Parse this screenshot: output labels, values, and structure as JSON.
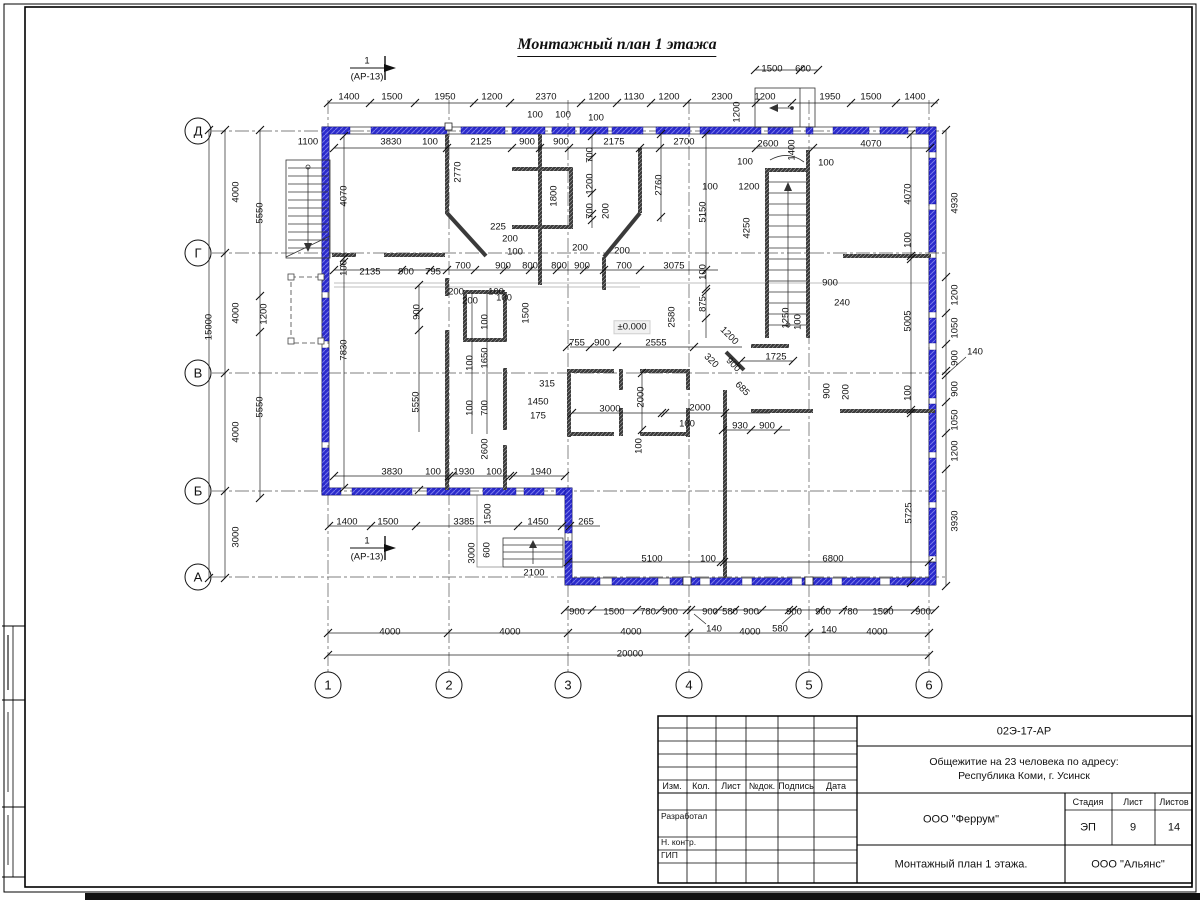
{
  "drawing_title": "Монтажный план 1 этажа",
  "level_mark": "±0.000",
  "axes": {
    "rows": [
      {
        "label": "Д",
        "x": 198,
        "y": 131
      },
      {
        "label": "Г",
        "x": 198,
        "y": 253
      },
      {
        "label": "В",
        "x": 198,
        "y": 373
      },
      {
        "label": "Б",
        "x": 198,
        "y": 491
      },
      {
        "label": "А",
        "x": 198,
        "y": 577
      }
    ],
    "cols": [
      {
        "label": "1",
        "x": 328,
        "y": 685
      },
      {
        "label": "2",
        "x": 449,
        "y": 685
      },
      {
        "label": "3",
        "x": 568,
        "y": 685
      },
      {
        "label": "4",
        "x": 689,
        "y": 685
      },
      {
        "label": "5",
        "x": 809,
        "y": 685
      },
      {
        "label": "6",
        "x": 929,
        "y": 685
      }
    ]
  },
  "section_marks": [
    {
      "num": "1",
      "ref": "(АР-13)",
      "x": 367,
      "y_num": 61,
      "y_ref": 77
    },
    {
      "num": "1",
      "ref": "(АР-13)",
      "x": 367,
      "y_num": 541,
      "y_ref": 557
    }
  ],
  "labels": [
    {
      "t": "1400",
      "x": 349,
      "y": 97
    },
    {
      "t": "1500",
      "x": 392,
      "y": 97
    },
    {
      "t": "1950",
      "x": 445,
      "y": 97
    },
    {
      "t": "1200",
      "x": 492,
      "y": 97
    },
    {
      "t": "2370",
      "x": 546,
      "y": 97
    },
    {
      "t": "1200",
      "x": 599,
      "y": 97
    },
    {
      "t": "1130",
      "x": 634,
      "y": 97
    },
    {
      "t": "1200",
      "x": 669,
      "y": 97
    },
    {
      "t": "2300",
      "x": 722,
      "y": 97
    },
    {
      "t": "1200",
      "x": 765,
      "y": 97
    },
    {
      "t": "1950",
      "x": 830,
      "y": 97
    },
    {
      "t": "1500",
      "x": 871,
      "y": 97
    },
    {
      "t": "1400",
      "x": 915,
      "y": 97
    },
    {
      "t": "1500",
      "x": 772,
      "y": 69
    },
    {
      "t": "600",
      "x": 803,
      "y": 69
    },
    {
      "t": "1200",
      "x": 737,
      "y": 112,
      "r": -90
    },
    {
      "t": "1100",
      "x": 308,
      "y": 142
    },
    {
      "t": "3830",
      "x": 391,
      "y": 142
    },
    {
      "t": "100",
      "x": 430,
      "y": 142
    },
    {
      "t": "2125",
      "x": 481,
      "y": 142
    },
    {
      "t": "900",
      "x": 527,
      "y": 142
    },
    {
      "t": "900",
      "x": 561,
      "y": 142
    },
    {
      "t": "2175",
      "x": 614,
      "y": 142
    },
    {
      "t": "2700",
      "x": 684,
      "y": 142
    },
    {
      "t": "2600",
      "x": 768,
      "y": 144
    },
    {
      "t": "1400",
      "x": 792,
      "y": 150,
      "r": -90
    },
    {
      "t": "4070",
      "x": 871,
      "y": 144
    },
    {
      "t": "100",
      "x": 535,
      "y": 115
    },
    {
      "t": "100",
      "x": 563,
      "y": 115
    },
    {
      "t": "100",
      "x": 596,
      "y": 118
    },
    {
      "t": "100",
      "x": 745,
      "y": 162
    },
    {
      "t": "100",
      "x": 826,
      "y": 163
    },
    {
      "t": "100",
      "x": 710,
      "y": 187
    },
    {
      "t": "1200",
      "x": 749,
      "y": 187
    },
    {
      "t": "15000",
      "x": 209,
      "y": 327,
      "r": -90
    },
    {
      "t": "4000",
      "x": 236,
      "y": 192,
      "r": -90
    },
    {
      "t": "5550",
      "x": 260,
      "y": 213,
      "r": -90
    },
    {
      "t": "4000",
      "x": 236,
      "y": 313,
      "r": -90
    },
    {
      "t": "1200",
      "x": 264,
      "y": 314,
      "r": -90
    },
    {
      "t": "4000",
      "x": 236,
      "y": 432,
      "r": -90
    },
    {
      "t": "5550",
      "x": 260,
      "y": 407,
      "r": -90
    },
    {
      "t": "3000",
      "x": 236,
      "y": 537,
      "r": -90
    },
    {
      "t": "4070",
      "x": 344,
      "y": 196,
      "r": -90
    },
    {
      "t": "100",
      "x": 344,
      "y": 268,
      "r": -90
    },
    {
      "t": "7830",
      "x": 344,
      "y": 350,
      "r": -90
    },
    {
      "t": "2770",
      "x": 458,
      "y": 172,
      "r": -90
    },
    {
      "t": "1800",
      "x": 554,
      "y": 196,
      "r": -90
    },
    {
      "t": "700",
      "x": 590,
      "y": 155,
      "r": -90
    },
    {
      "t": "1200",
      "x": 590,
      "y": 184,
      "r": -90
    },
    {
      "t": "700",
      "x": 590,
      "y": 211,
      "r": -90
    },
    {
      "t": "200",
      "x": 606,
      "y": 211,
      "r": -90
    },
    {
      "t": "225",
      "x": 498,
      "y": 227
    },
    {
      "t": "200",
      "x": 510,
      "y": 239
    },
    {
      "t": "100",
      "x": 515,
      "y": 252
    },
    {
      "t": "2760",
      "x": 659,
      "y": 185,
      "r": -90
    },
    {
      "t": "5150",
      "x": 703,
      "y": 212,
      "r": -90
    },
    {
      "t": "2135",
      "x": 370,
      "y": 272
    },
    {
      "t": "900",
      "x": 406,
      "y": 272
    },
    {
      "t": "795",
      "x": 433,
      "y": 272
    },
    {
      "t": "700",
      "x": 463,
      "y": 266
    },
    {
      "t": "900",
      "x": 503,
      "y": 266
    },
    {
      "t": "800",
      "x": 530,
      "y": 266
    },
    {
      "t": "800",
      "x": 559,
      "y": 266
    },
    {
      "t": "900",
      "x": 582,
      "y": 266
    },
    {
      "t": "700",
      "x": 624,
      "y": 266
    },
    {
      "t": "3075",
      "x": 674,
      "y": 266
    },
    {
      "t": "200",
      "x": 580,
      "y": 248
    },
    {
      "t": "200",
      "x": 622,
      "y": 251
    },
    {
      "t": "200",
      "x": 456,
      "y": 292
    },
    {
      "t": "100",
      "x": 496,
      "y": 292
    },
    {
      "t": "100",
      "x": 703,
      "y": 272,
      "r": -90
    },
    {
      "t": "875",
      "x": 703,
      "y": 304,
      "r": -90
    },
    {
      "t": "2580",
      "x": 672,
      "y": 317,
      "r": -90
    },
    {
      "t": "2555",
      "x": 656,
      "y": 343
    },
    {
      "t": "755",
      "x": 577,
      "y": 343
    },
    {
      "t": "900",
      "x": 602,
      "y": 343
    },
    {
      "t": "1200",
      "x": 729,
      "y": 336,
      "r": 45
    },
    {
      "t": "320",
      "x": 711,
      "y": 361,
      "r": 45
    },
    {
      "t": "900",
      "x": 733,
      "y": 365,
      "r": 45
    },
    {
      "t": "685",
      "x": 742,
      "y": 389,
      "r": 45
    },
    {
      "t": "1725",
      "x": 776,
      "y": 357
    },
    {
      "t": "1250",
      "x": 786,
      "y": 318,
      "r": -90
    },
    {
      "t": "100",
      "x": 798,
      "y": 322,
      "r": -90
    },
    {
      "t": "4250",
      "x": 747,
      "y": 228,
      "r": -90
    },
    {
      "t": "900",
      "x": 830,
      "y": 283
    },
    {
      "t": "240",
      "x": 842,
      "y": 303
    },
    {
      "t": "4070",
      "x": 908,
      "y": 194,
      "r": -90
    },
    {
      "t": "100",
      "x": 908,
      "y": 240,
      "r": -90
    },
    {
      "t": "5005",
      "x": 908,
      "y": 321,
      "r": -90
    },
    {
      "t": "100",
      "x": 908,
      "y": 393,
      "r": -90
    },
    {
      "t": "5725",
      "x": 909,
      "y": 513,
      "r": -90
    },
    {
      "t": "900",
      "x": 827,
      "y": 391,
      "r": -90
    },
    {
      "t": "200",
      "x": 846,
      "y": 392,
      "r": -90
    },
    {
      "t": "4930",
      "x": 955,
      "y": 203,
      "r": -90
    },
    {
      "t": "1200",
      "x": 955,
      "y": 295,
      "r": -90
    },
    {
      "t": "1050",
      "x": 955,
      "y": 328,
      "r": -90
    },
    {
      "t": "900",
      "x": 955,
      "y": 358,
      "r": -90
    },
    {
      "t": "140",
      "x": 975,
      "y": 352
    },
    {
      "t": "900",
      "x": 955,
      "y": 389,
      "r": -90
    },
    {
      "t": "1050",
      "x": 955,
      "y": 420,
      "r": -90
    },
    {
      "t": "1200",
      "x": 955,
      "y": 451,
      "r": -90
    },
    {
      "t": "3930",
      "x": 955,
      "y": 521,
      "r": -90
    },
    {
      "t": "900",
      "x": 417,
      "y": 312,
      "r": -90
    },
    {
      "t": "200",
      "x": 470,
      "y": 301
    },
    {
      "t": "100",
      "x": 504,
      "y": 298
    },
    {
      "t": "1500",
      "x": 526,
      "y": 313,
      "r": -90
    },
    {
      "t": "100",
      "x": 485,
      "y": 322,
      "r": -90
    },
    {
      "t": "1650",
      "x": 485,
      "y": 358,
      "r": -90
    },
    {
      "t": "100",
      "x": 470,
      "y": 363,
      "r": -90
    },
    {
      "t": "5550",
      "x": 416,
      "y": 402,
      "r": -90
    },
    {
      "t": "100",
      "x": 470,
      "y": 408,
      "r": -90
    },
    {
      "t": "700",
      "x": 485,
      "y": 408,
      "r": -90
    },
    {
      "t": "2600",
      "x": 485,
      "y": 449,
      "r": -90
    },
    {
      "t": "315",
      "x": 547,
      "y": 384
    },
    {
      "t": "1450",
      "x": 538,
      "y": 402
    },
    {
      "t": "175",
      "x": 538,
      "y": 416
    },
    {
      "t": "3000",
      "x": 610,
      "y": 409
    },
    {
      "t": "2000",
      "x": 641,
      "y": 397,
      "r": -90
    },
    {
      "t": "2000",
      "x": 700,
      "y": 408
    },
    {
      "t": "100",
      "x": 687,
      "y": 424
    },
    {
      "t": "930",
      "x": 740,
      "y": 426
    },
    {
      "t": "900",
      "x": 767,
      "y": 426
    },
    {
      "t": "100",
      "x": 639,
      "y": 446,
      "r": -90
    },
    {
      "t": "3830",
      "x": 392,
      "y": 472
    },
    {
      "t": "100",
      "x": 433,
      "y": 472
    },
    {
      "t": "1930",
      "x": 464,
      "y": 472
    },
    {
      "t": "100",
      "x": 494,
      "y": 472
    },
    {
      "t": "1940",
      "x": 541,
      "y": 472
    },
    {
      "t": "1400",
      "x": 347,
      "y": 522
    },
    {
      "t": "1500",
      "x": 388,
      "y": 522
    },
    {
      "t": "3385",
      "x": 464,
      "y": 522
    },
    {
      "t": "1500",
      "x": 488,
      "y": 514,
      "r": -90
    },
    {
      "t": "1450",
      "x": 538,
      "y": 522
    },
    {
      "t": "265",
      "x": 586,
      "y": 522
    },
    {
      "t": "3000",
      "x": 472,
      "y": 553,
      "r": -90
    },
    {
      "t": "600",
      "x": 487,
      "y": 550,
      "r": -90
    },
    {
      "t": "2100",
      "x": 534,
      "y": 573
    },
    {
      "t": "5100",
      "x": 652,
      "y": 559
    },
    {
      "t": "100",
      "x": 708,
      "y": 559
    },
    {
      "t": "6800",
      "x": 833,
      "y": 559
    },
    {
      "t": "900",
      "x": 577,
      "y": 612
    },
    {
      "t": "1500",
      "x": 614,
      "y": 612
    },
    {
      "t": "780",
      "x": 648,
      "y": 612
    },
    {
      "t": "900",
      "x": 670,
      "y": 612
    },
    {
      "t": "900",
      "x": 710,
      "y": 612
    },
    {
      "t": "580",
      "x": 730,
      "y": 612
    },
    {
      "t": "900",
      "x": 751,
      "y": 612
    },
    {
      "t": "900",
      "x": 794,
      "y": 612
    },
    {
      "t": "900",
      "x": 823,
      "y": 612
    },
    {
      "t": "780",
      "x": 850,
      "y": 612
    },
    {
      "t": "1500",
      "x": 883,
      "y": 612
    },
    {
      "t": "900",
      "x": 923,
      "y": 612
    },
    {
      "t": "140",
      "x": 714,
      "y": 629
    },
    {
      "t": "580",
      "x": 780,
      "y": 629
    },
    {
      "t": "140",
      "x": 829,
      "y": 630
    },
    {
      "t": "4000",
      "x": 390,
      "y": 632
    },
    {
      "t": "4000",
      "x": 510,
      "y": 632
    },
    {
      "t": "4000",
      "x": 631,
      "y": 632
    },
    {
      "t": "4000",
      "x": 750,
      "y": 632
    },
    {
      "t": "4000",
      "x": 877,
      "y": 632
    },
    {
      "t": "20000",
      "x": 630,
      "y": 654
    },
    {
      "t": "±0.000",
      "x": 632,
      "y": 327
    }
  ],
  "title_block": {
    "doc_number": "02Э-17-АР",
    "project_line1": "Общежитие на 23 человека по адресу:",
    "project_line2": "Республика Коми, г. Усинск",
    "org": "ООО \"Феррум\"",
    "stage_label": "Стадия",
    "sheet_label": "Лист",
    "sheets_label": "Листов",
    "stage": "ЭП",
    "sheet": "9",
    "sheets": "14",
    "drawing_name": "Монтажный план 1 этажа.",
    "company": "ООО \"Альянс\"",
    "columns": [
      "Изм.",
      "Кол.",
      "Лист",
      "№док.",
      "Подпись",
      "Дата"
    ],
    "rows": [
      "Разработал",
      "Н. контр.",
      "ГИП"
    ]
  }
}
